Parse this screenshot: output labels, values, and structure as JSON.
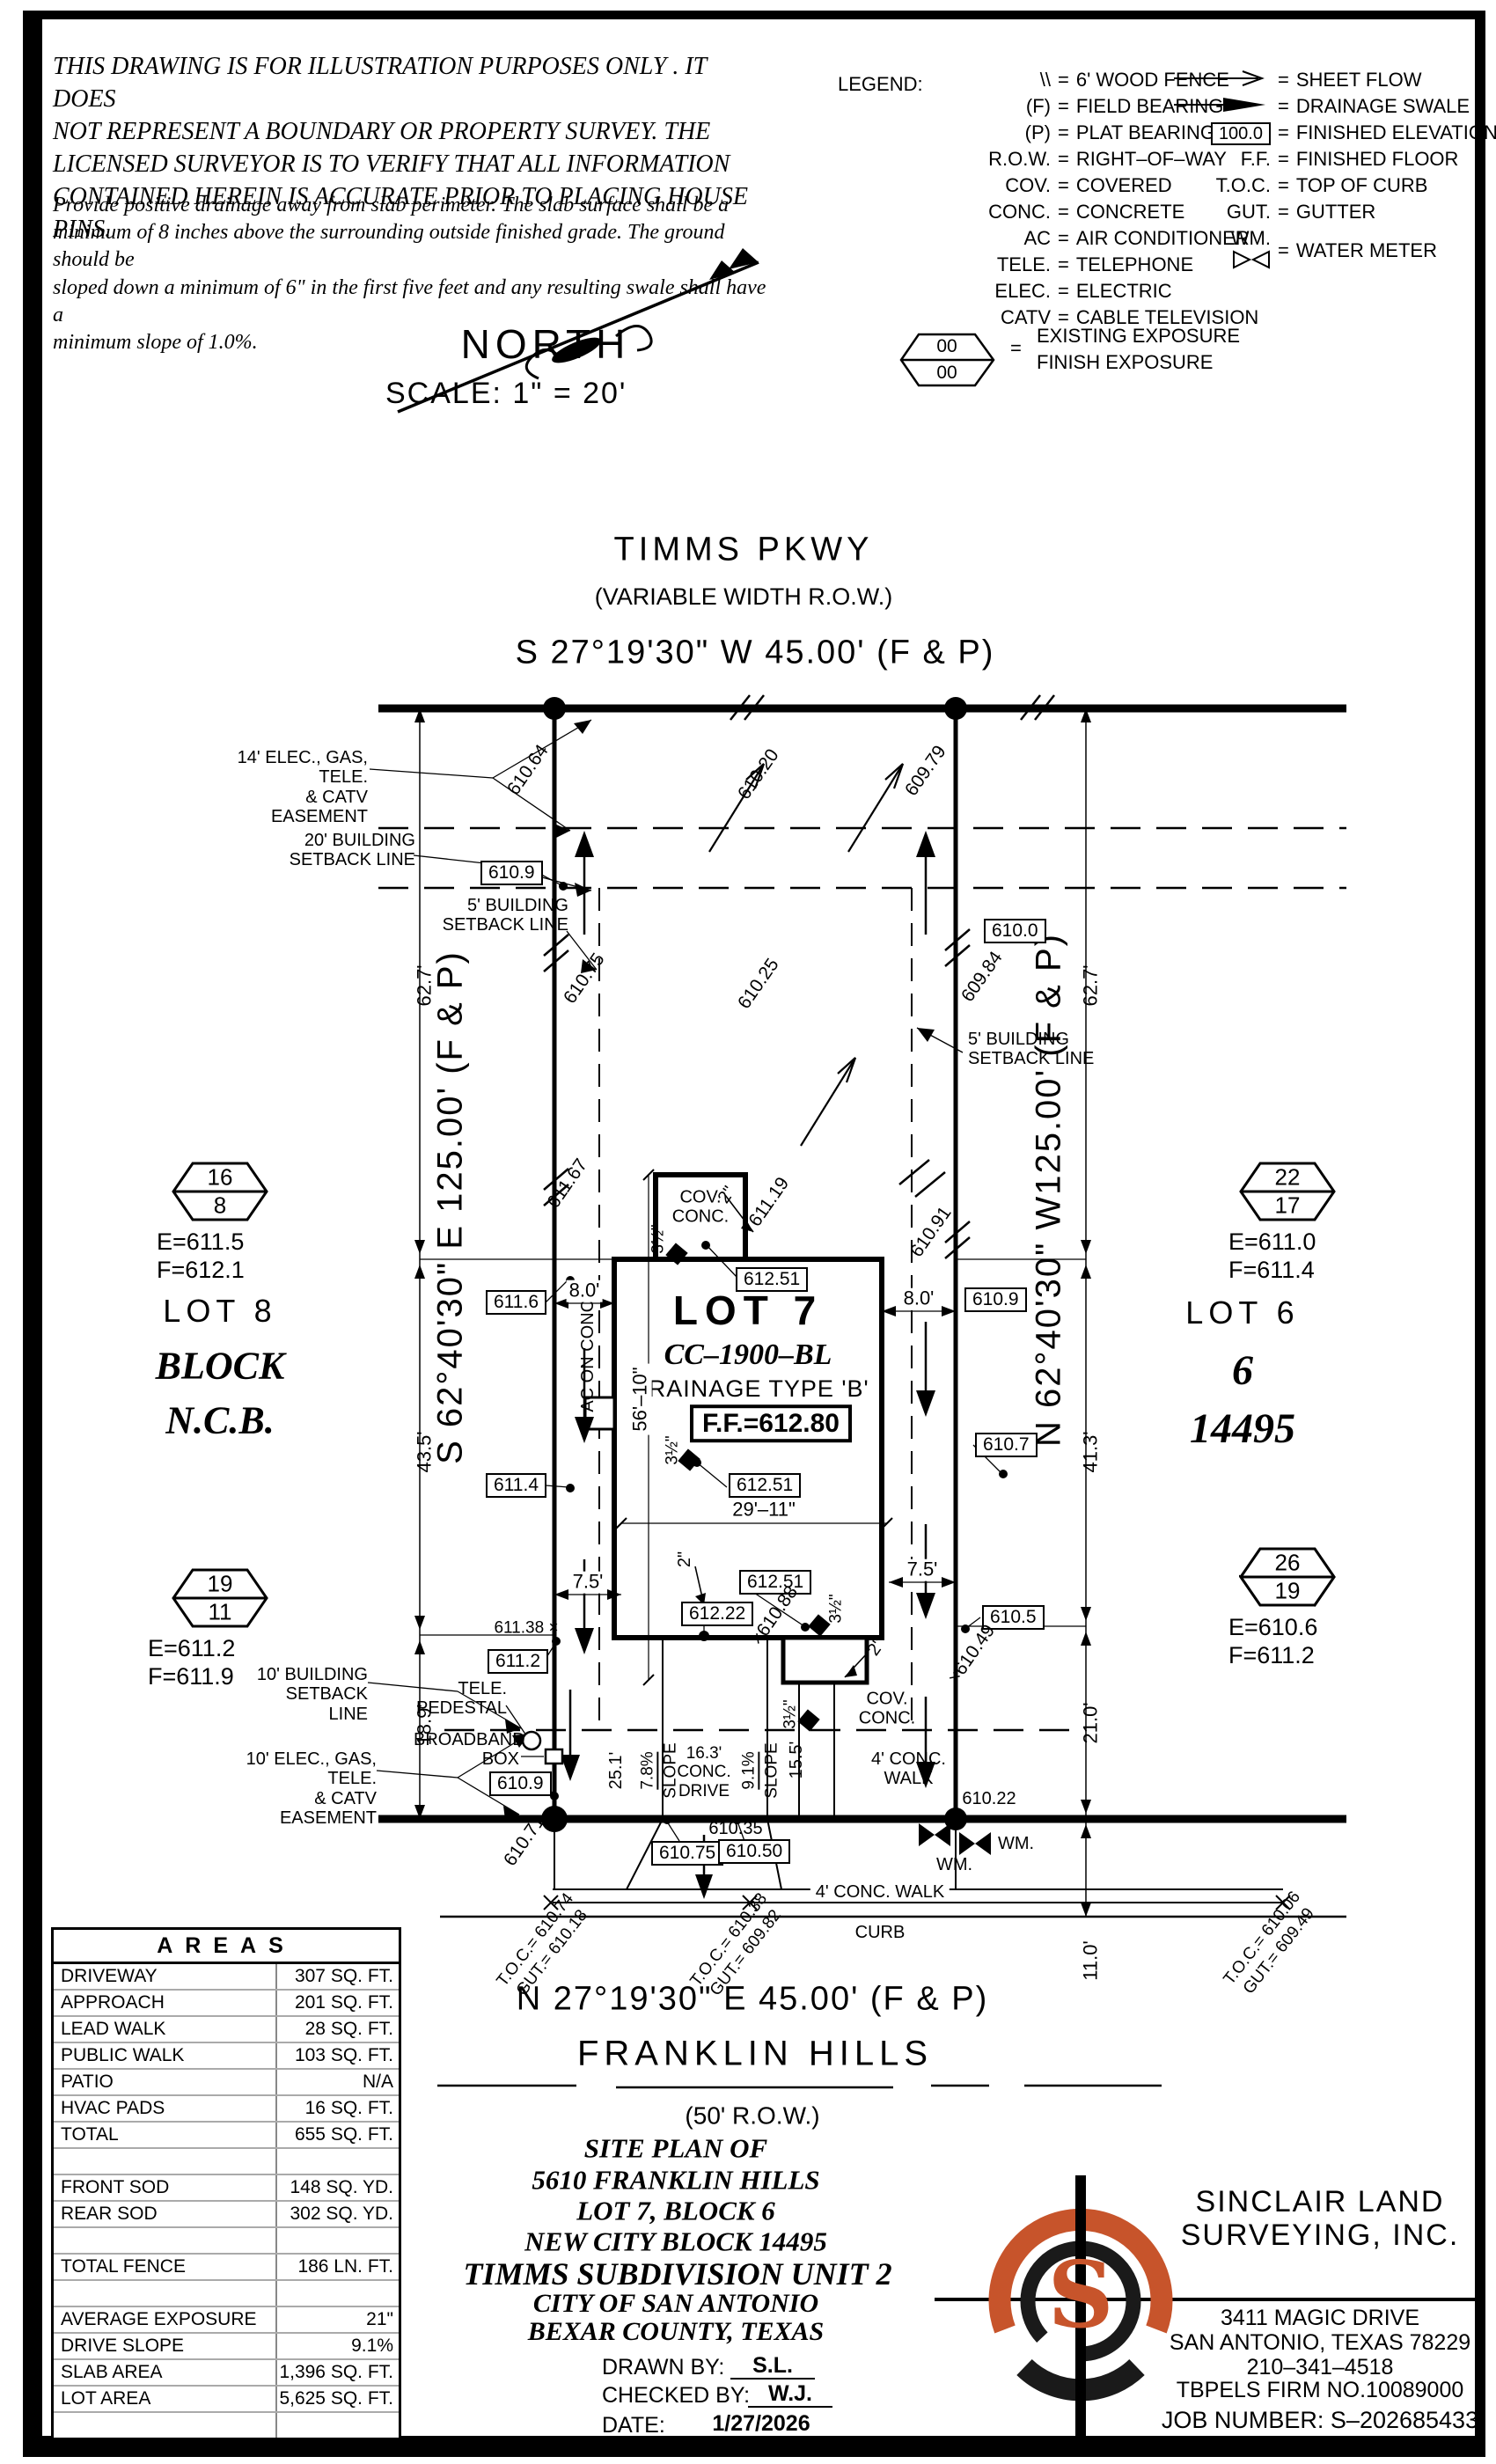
{
  "disclaimer": {
    "para1": "THIS DRAWING IS FOR ILLUSTRATION PURPOSES ONLY . IT DOES\nNOT REPRESENT A BOUNDARY OR PROPERTY SURVEY. THE\nLICENSED SURVEYOR IS TO VERIFY THAT ALL INFORMATION\nCONTAINED HEREIN IS ACCURATE PRIOR TO PLACING HOUSE PINS.",
    "para2": "Provide positive drainage away from slab perimeter. The slab surface shall be a\nminimum of 8 inches above the surrounding outside finished grade. The ground should be\nsloped down a minimum of 6\" in the first five feet and any resulting swale shall have a\nminimum slope of 1.0%."
  },
  "legend": {
    "title": "LEGEND:",
    "left": [
      {
        "s": "\\\\",
        "d": "6' WOOD FENCE"
      },
      {
        "s": "(F)",
        "d": "FIELD BEARING"
      },
      {
        "s": "(P)",
        "d": "PLAT BEARING"
      },
      {
        "s": "R.O.W.",
        "d": "RIGHT–OF–WAY"
      },
      {
        "s": "COV.",
        "d": "COVERED"
      },
      {
        "s": "CONC.",
        "d": "CONCRETE"
      },
      {
        "s": "AC",
        "d": "AIR CONDITIONER"
      },
      {
        "s": "TELE.",
        "d": "TELEPHONE"
      },
      {
        "s": "ELEC.",
        "d": "ELECTRIC"
      },
      {
        "s": "CATV",
        "d": "CABLE TELEVISION"
      }
    ],
    "right": [
      {
        "s": "",
        "d": "SHEET FLOW"
      },
      {
        "s": "",
        "d": "DRAINAGE SWALE"
      },
      {
        "s": "100.0",
        "d": "FINISHED ELEVATION"
      },
      {
        "s": "F.F.",
        "d": "FINISHED FLOOR"
      },
      {
        "s": "T.O.C.",
        "d": "TOP OF CURB"
      },
      {
        "s": "GUT.",
        "d": "GUTTER"
      },
      {
        "s": "WM.",
        "d": "WATER METER"
      }
    ],
    "hex_top": "00",
    "hex_bottom": "00",
    "exist": "EXISTING EXPOSURE",
    "finish": "FINISH EXPOSURE"
  },
  "north": {
    "label": "NORTH",
    "scale": "SCALE: 1\" = 20'"
  },
  "top_street": {
    "name": "TIMMS PKWY",
    "row": "(VARIABLE WIDTH R.O.W.)",
    "bearing": "S 27°19'30\" W 45.00' (F & P)"
  },
  "bottom_street": {
    "bearing": "N 27°19'30\" E 45.00' (F & P)",
    "name": "FRANKLIN HILLS",
    "row": "(50' R.O.W.)"
  },
  "bearings": {
    "left": "S 62°40'30\" E 125.00' (F & P)",
    "right": "N 62°40'30\" W125.00' (F & P)"
  },
  "neighbors": {
    "lot8": "LOT 8",
    "block": "BLOCK",
    "ncb": "N.C.B.",
    "lot6": "LOT 6",
    "six": "6",
    "n14495": "14495"
  },
  "hex": {
    "lt": {
      "a": "16",
      "b": "8",
      "e": "E=611.5",
      "f": "F=612.1"
    },
    "lb": {
      "a": "19",
      "b": "11",
      "e": "E=611.2",
      "f": "F=611.9"
    },
    "rt": {
      "a": "22",
      "b": "17",
      "e": "E=611.0",
      "f": "F=611.4"
    },
    "rb": {
      "a": "26",
      "b": "19",
      "e": "E=610.6",
      "f": "F=611.2"
    }
  },
  "lot7": {
    "name": "LOT 7",
    "cc": "CC–1900–BL",
    "drainage": "DRAINAGE TYPE 'B'",
    "ff": "F.F.=612.80"
  },
  "easements": {
    "e14": "14' ELEC., GAS, TELE.\n& CATV EASEMENT",
    "sb20": "20' BUILDING\nSETBACK LINE",
    "sb5l": "5' BUILDING\nSETBACK LINE",
    "sb5r": "5' BUILDING\nSETBACK LINE",
    "sb10": "10' BUILDING\nSETBACK LINE",
    "e10": "10' ELEC., GAS, TELE.\n& CATV EASEMENT"
  },
  "dims": {
    "d62_7l": "62.7'",
    "d62_7r": "62.7'",
    "d43_5": "43.5'",
    "d18_9": "18.9'",
    "d41_3": "41.3'",
    "d21_0": "21.0'",
    "d11_0": "11.0'",
    "d8l": "8.0'",
    "d8r": "8.0'",
    "d7_5l": "7.5'",
    "d7_5r": "7.5'",
    "d29_11": "29'–11\"",
    "d56_10": "56'–10\"",
    "d25_1": "25.1'",
    "d15_5": "15.5'",
    "slope78": "7.8%",
    "slope91": "9.1%",
    "slopeword": "SLOPE",
    "in2": "2\"",
    "in35": "3½\""
  },
  "boxed": {
    "b610_9a": "610.9",
    "b610_0": "610.0",
    "b611_6": "611.6",
    "b611_4": "611.4",
    "b612_51": "612.51",
    "b612_22": "612.22",
    "b610_9b": "610.9",
    "b610_7": "610.7",
    "b610_5": "610.5",
    "b611_2": "611.2",
    "b610_9c": "610.9",
    "b610_75": "610.75",
    "b610_50": "610.50"
  },
  "spots": {
    "s610_64": "610.64",
    "s610_20": "610.20",
    "s609_79": "609.79",
    "s610_75": "610.75",
    "s610_25": "610.25",
    "s609_84": "609.84",
    "s611_67": "611.67",
    "s611_19": "611.19",
    "s610_91": "610.91",
    "s610_88": "×610.88",
    "s611_38": "611.38 ×",
    "s610_49": "×610.49",
    "s610_71": "610.71",
    "s610_35": "610.35",
    "s610_22": "610.22"
  },
  "site": {
    "cov_conc": "COV.\nCONC.",
    "ac": "AC ON CONC.",
    "tele": "TELE.\nPEDESTAL",
    "broadband": "BROADBAND\nBOX",
    "walk4a": "4' CONC.\nWALK",
    "walk4b": "4' CONC. WALK",
    "curb": "CURB",
    "wm": "WM.",
    "drive": "16.3'\nCONC.\nDRIVE"
  },
  "toc": [
    {
      "l1": "T.O.C.= 610.74",
      "l2": "GUT.= 610.18"
    },
    {
      "l1": "T.O.C.= 610.38",
      "l2": "GUT.= 609.82"
    },
    {
      "l1": "T.O.C.= 610.06",
      "l2": "GUT.= 609.49"
    }
  ],
  "areas": {
    "title": "AREAS",
    "rows": [
      {
        "label": "DRIVEWAY",
        "value": "307 SQ. FT."
      },
      {
        "label": "APPROACH",
        "value": "201 SQ. FT."
      },
      {
        "label": "LEAD WALK",
        "value": "28 SQ. FT."
      },
      {
        "label": "PUBLIC WALK",
        "value": "103 SQ. FT."
      },
      {
        "label": "PATIO",
        "value": "N/A"
      },
      {
        "label": "HVAC PADS",
        "value": "16 SQ. FT."
      },
      {
        "label": "TOTAL",
        "value": "655 SQ. FT."
      },
      {
        "label": "",
        "value": ""
      },
      {
        "label": "FRONT SOD",
        "value": "148 SQ. YD."
      },
      {
        "label": "REAR SOD",
        "value": "302 SQ. YD."
      },
      {
        "label": "",
        "value": ""
      },
      {
        "label": "TOTAL FENCE",
        "value": "186 LN. FT."
      },
      {
        "label": "",
        "value": ""
      },
      {
        "label": "AVERAGE EXPOSURE",
        "value": "21\""
      },
      {
        "label": "DRIVE SLOPE",
        "value": "9.1%"
      },
      {
        "label": "SLAB AREA",
        "value": "1,396 SQ. FT."
      },
      {
        "label": "LOT AREA",
        "value": "5,625 SQ. FT."
      },
      {
        "label": "",
        "value": ""
      }
    ]
  },
  "title_block": {
    "l1": "SITE PLAN OF",
    "l2": "5610 FRANKLIN HILLS",
    "l3": "LOT 7, BLOCK 6",
    "l4": "NEW CITY BLOCK 14495",
    "l5": "TIMMS SUBDIVISION UNIT 2",
    "l6": "CITY OF SAN ANTONIO",
    "l7": "BEXAR COUNTY, TEXAS",
    "drawn_label": "DRAWN BY:",
    "drawn": "S.L.",
    "checked_label": "CHECKED BY:",
    "checked": "W.J.",
    "date_label": "DATE:",
    "date": "1/27/2026"
  },
  "firm": {
    "logo_letter": "S",
    "name1": "SINCLAIR LAND",
    "name2": "SURVEYING, INC.",
    "addr1": "3411 MAGIC DRIVE",
    "addr2": "SAN ANTONIO, TEXAS 78229",
    "phone": "210–341–4518",
    "tbpels": "TBPELS FIRM NO.10089000",
    "job": "JOB NUMBER: S–202685433",
    "accent": "#c7542b"
  }
}
